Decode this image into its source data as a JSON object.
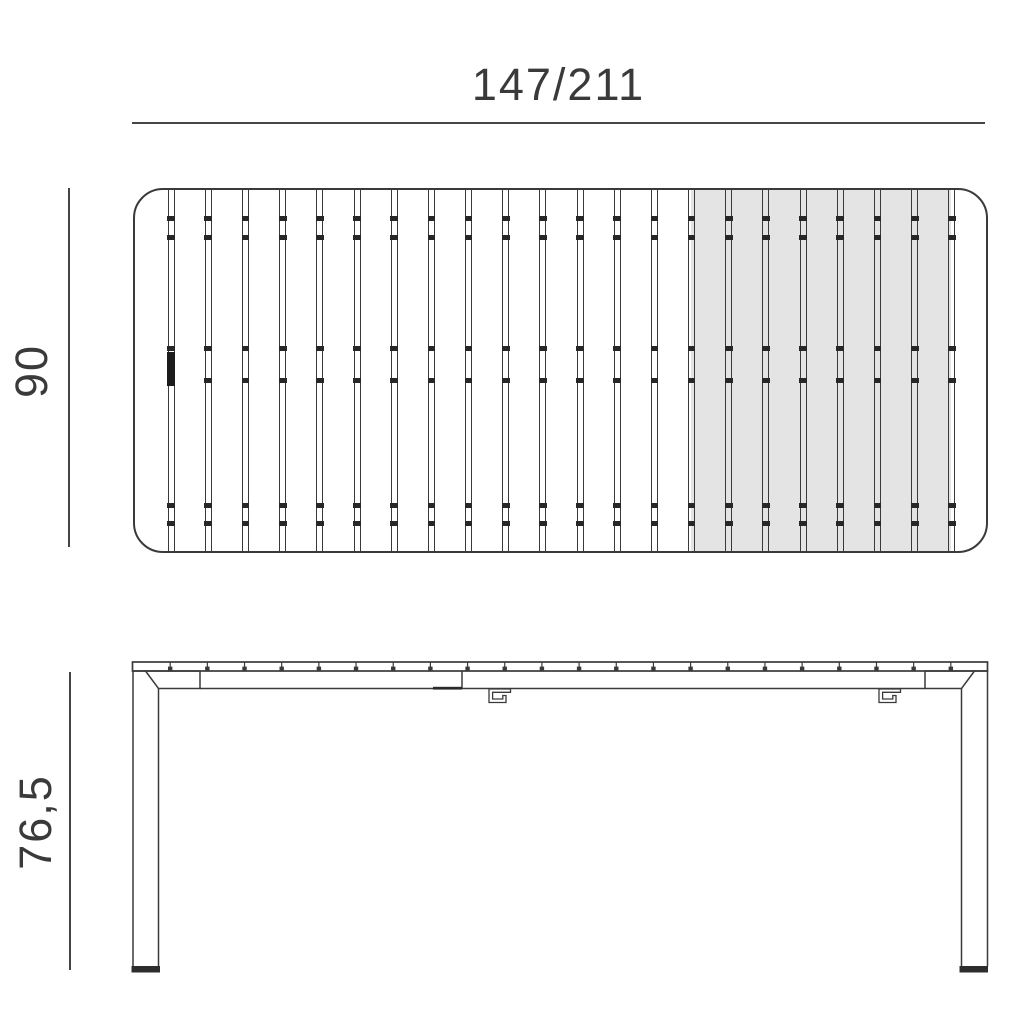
{
  "diagram": {
    "dimensions": {
      "length": "147/211",
      "depth": "90",
      "height": "76,5"
    }
  },
  "colors": {
    "line": "#3a3a3a",
    "dim_line": "#454545",
    "slat_shaded": "#e4e4e4",
    "foot": "#2d2d2d",
    "background": "#ffffff"
  },
  "top_view": {
    "slat_count": 23,
    "shaded_slat_range": [
      16,
      22
    ],
    "divider_tick_offsets": [
      28,
      47,
      158,
      190,
      315,
      333
    ],
    "latch_divider_index": 1,
    "latch_offset": 162,
    "latch_height": 34
  }
}
